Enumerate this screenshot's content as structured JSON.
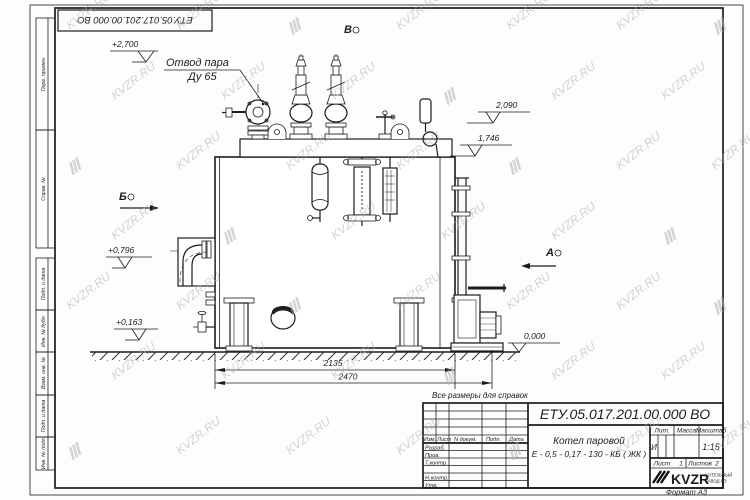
{
  "sheet": {
    "watermark": "KVZR.RU",
    "format_label": "Формат А3",
    "reference_note": "Все размеры для справок",
    "top_stamp": "ЕТУ.05.017.201.00.000  ВО"
  },
  "side_columns": {
    "perv_primen": "Перв. примен.",
    "sprav_no": "Справ. №",
    "podp_data_1": "Подп. и дата",
    "inv_dubl": "Инв. № дубл.",
    "vzam_inv": "Взам. инв. №",
    "podp_data_2": "Подп. и дата",
    "inv_podl": "Инв. № подл."
  },
  "annotations": {
    "steam_outlet_line1": "Отвод пара",
    "steam_outlet_line2": "Ду 65",
    "levels": {
      "l2700": "+2,700",
      "l2090": "2,090",
      "l1746": "1,746",
      "l0796": "+0,796",
      "l0163": "+0,163",
      "l0000": "0,000"
    },
    "views": {
      "v": "В",
      "b": "Б",
      "a": "А"
    },
    "dims": {
      "d1": "2135",
      "d2": "2470"
    }
  },
  "title_block": {
    "doc_number": "ЕТУ.05.017.201.00.000  ВО",
    "product_line1": "Котел паровой",
    "product_line2": "Е - 0,5 - 0,17 - 130 - КБ ( ЖК )",
    "col_izm": "Изм.",
    "col_list": "Лист",
    "col_ndoc": "N докум.",
    "col_podp": "Подп.",
    "col_data": "Дата",
    "row_razrab": "Разраб.",
    "row_prov": "Пров.",
    "row_tkontr": "Т.контр.",
    "row_nkontr": "Н.контр.",
    "row_utv": "Утв.",
    "lit_label": "Лит.",
    "mass_label": "Масса",
    "scale_label": "Масштаб",
    "lit_value": "И",
    "scale_value": "1:15",
    "sheet_label": "Лист",
    "sheet_value": "1",
    "sheets_label": "Листов",
    "sheets_value": "2",
    "logo_text": "KVZR",
    "logo_sub1": "КОТЕЛЬНЫЙ",
    "logo_sub2": "ЗАВОД РЭ"
  }
}
